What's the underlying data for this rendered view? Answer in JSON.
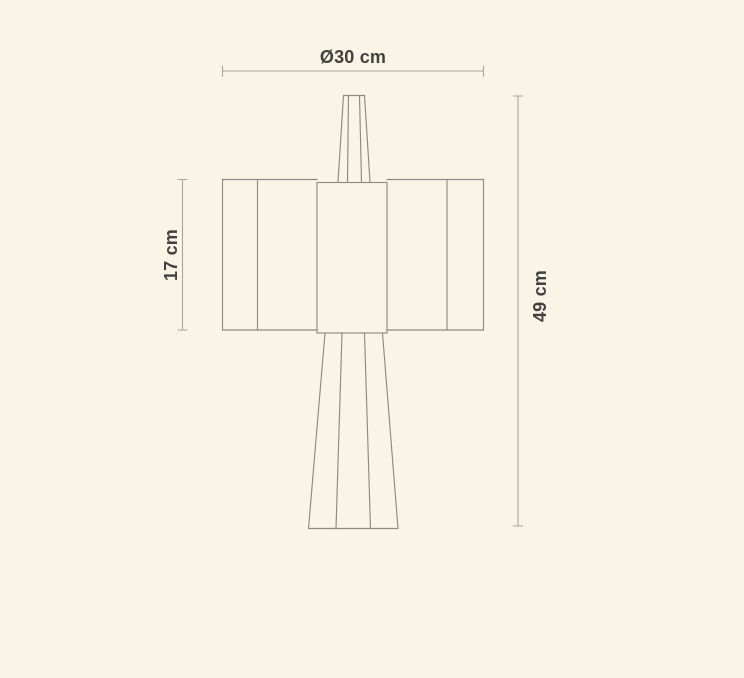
{
  "page": {
    "background_color": "#FAF4E7",
    "description": "Technical dimension drawing of a table lamp (front elevation)"
  },
  "drawing": {
    "outline_color": "#8D8A82",
    "dimension_line_color": "#ACA496",
    "label_color": "#434140",
    "labels": {
      "diameter": "Ø30 cm",
      "shade_height": "17 cm",
      "total_height": "49 cm"
    }
  }
}
